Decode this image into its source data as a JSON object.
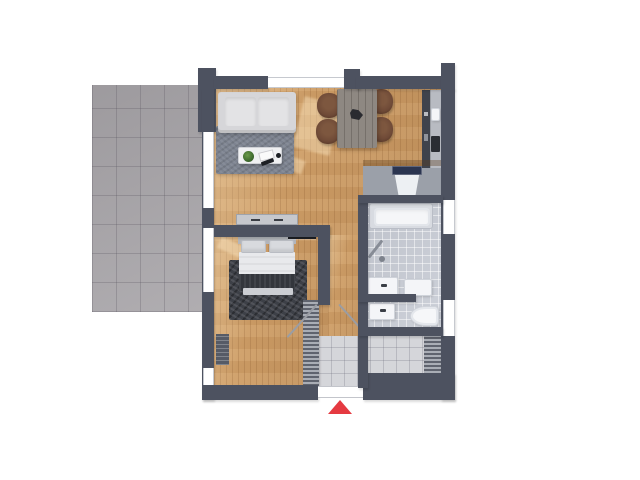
{
  "scene": {
    "type": "3d-rendered-floor-plan-top-view",
    "background": "#ffffff",
    "rooms": [
      {
        "name": "terrace",
        "floor": "grey-tiles"
      },
      {
        "name": "living-room",
        "furniture": [
          "sofa",
          "area-rug",
          "coffee-table-tray",
          "plant",
          "book",
          "remote"
        ]
      },
      {
        "name": "dining-area",
        "furniture": [
          "dining-table",
          "chair",
          "chair",
          "chair",
          "chair",
          "centerpiece"
        ]
      },
      {
        "name": "kitchen",
        "furniture": [
          "counter-along-wall",
          "sink",
          "hob",
          "washing-machine"
        ]
      },
      {
        "name": "bedroom",
        "furniture": [
          "double-bed",
          "pillows",
          "duvet",
          "throw-blanket",
          "bench",
          "dark-rug",
          "wall-tv",
          "sideboard",
          "radiator",
          "wardrobe"
        ]
      },
      {
        "name": "bathroom",
        "furniture": [
          "bathtub",
          "grab-bar",
          "washbasin",
          "cabinet",
          "wc-basin",
          "toilet"
        ]
      },
      {
        "name": "entrance-hall",
        "furniture": [
          "floor-grille",
          "floor-grille"
        ]
      }
    ]
  },
  "indicators": {
    "entrance-arrow": {
      "shape": "triangle",
      "direction": "up",
      "color": "#e53a41"
    }
  },
  "colors": {
    "wall": "#4d5260",
    "wood": "#cf9e66",
    "terrace": "#a7a4a8",
    "rug-living": "#7d8390",
    "sofa": "#d6d6d9",
    "table": "#8e8882",
    "chair": "#6f4a37",
    "counter": "#b8bbc2",
    "band": "#9ba0a9",
    "tile-bath": "#c9cdd6",
    "tile-hall": "#d5d6da",
    "rug-bed": "#3d4047",
    "duvet": "#e8e9ec",
    "throw": "#33363c",
    "fixture": "#f4f5f8",
    "navy": "#2b3550",
    "arrow": "#e53a41"
  }
}
